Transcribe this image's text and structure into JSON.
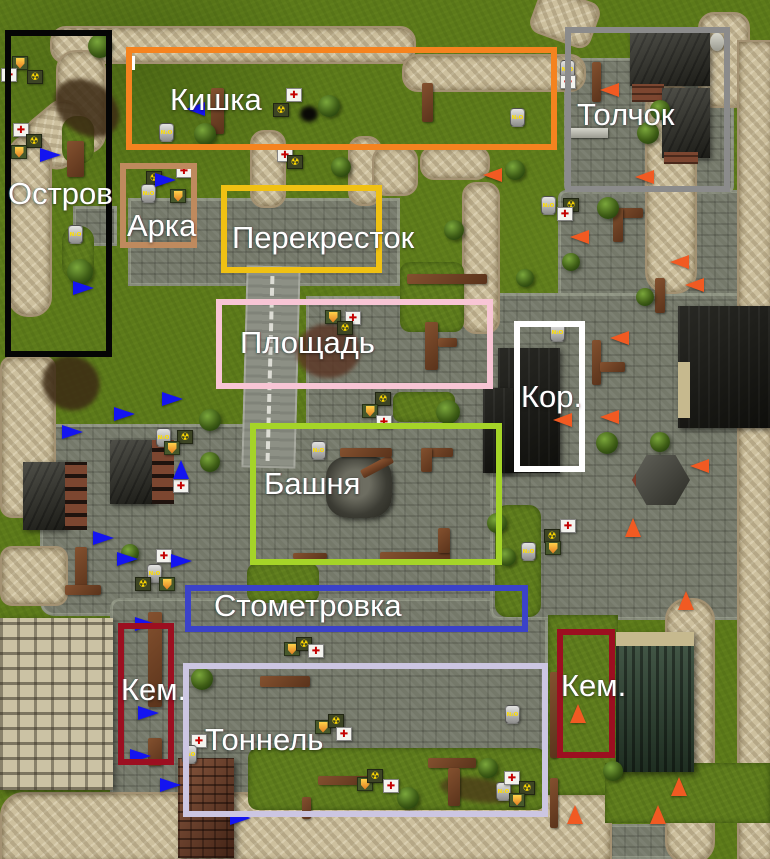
{
  "map_title": "Annotated game level map with callout zones and spawn markers",
  "regions": [
    {
      "name": "ostrov",
      "label": "Остров",
      "color": "#050505",
      "x": 5,
      "y": 30,
      "w": 107,
      "h": 327,
      "lx": 8,
      "ly": 178
    },
    {
      "name": "kishka",
      "label": "Кишка",
      "color": "#f5831f",
      "x": 126,
      "y": 47,
      "w": 431,
      "h": 103,
      "lx": 170,
      "ly": 84
    },
    {
      "name": "tolchok",
      "label": "Толчок",
      "color": "#8b8b8b",
      "x": 565,
      "y": 27,
      "w": 165,
      "h": 165,
      "lx": 577,
      "ly": 99
    },
    {
      "name": "arka",
      "label": "Арка",
      "color": "#bf8a5e",
      "x": 120,
      "y": 163,
      "w": 77,
      "h": 85,
      "lx": 127,
      "ly": 210
    },
    {
      "name": "perekrestok",
      "label": "Перекресток",
      "color": "#f0c113",
      "x": 221,
      "y": 185,
      "w": 161,
      "h": 88,
      "lx": 232,
      "ly": 222
    },
    {
      "name": "ploshchad",
      "label": "Площадь",
      "color": "#f8c5d5",
      "x": 216,
      "y": 299,
      "w": 277,
      "h": 90,
      "lx": 240,
      "ly": 327
    },
    {
      "name": "kor",
      "label": "Кор.",
      "color": "#ffffff",
      "x": 514,
      "y": 321,
      "w": 71,
      "h": 151,
      "lx": 521,
      "ly": 381
    },
    {
      "name": "bashnya",
      "label": "Башня",
      "color": "#a5d428",
      "x": 250,
      "y": 423,
      "w": 252,
      "h": 142,
      "lx": 264,
      "ly": 468
    },
    {
      "name": "stometrovka",
      "label": "Стометровка",
      "color": "#3b42c9",
      "x": 185,
      "y": 585,
      "w": 343,
      "h": 47,
      "lx": 214,
      "ly": 590
    },
    {
      "name": "kem-left",
      "label": "Кем.",
      "color": "#9c0f20",
      "x": 118,
      "y": 623,
      "w": 56,
      "h": 142,
      "lx": 121,
      "ly": 674
    },
    {
      "name": "kem-right",
      "label": "Кем.",
      "color": "#9c0f20",
      "x": 557,
      "y": 629,
      "w": 58,
      "h": 129,
      "lx": 561,
      "ly": 670
    },
    {
      "name": "tonnel",
      "label": "Тоннель",
      "color": "#ccc6e2",
      "x": 183,
      "y": 663,
      "w": 365,
      "h": 154,
      "lx": 205,
      "ly": 724
    }
  ],
  "markers": {
    "blue_color": "#1414f0",
    "orange_color": "#f15a22",
    "blue": [
      {
        "x": 50,
        "y": 155,
        "d": "right"
      },
      {
        "x": 83,
        "y": 288,
        "d": "right"
      },
      {
        "x": 165,
        "y": 180,
        "d": "right"
      },
      {
        "x": 196,
        "y": 109,
        "d": "left"
      },
      {
        "x": 172,
        "y": 399,
        "d": "right"
      },
      {
        "x": 124,
        "y": 414,
        "d": "right"
      },
      {
        "x": 72,
        "y": 432,
        "d": "right"
      },
      {
        "x": 183,
        "y": 470,
        "d": "up"
      },
      {
        "x": 103,
        "y": 538,
        "d": "right"
      },
      {
        "x": 127,
        "y": 559,
        "d": "right"
      },
      {
        "x": 181,
        "y": 561,
        "d": "right"
      },
      {
        "x": 145,
        "y": 624,
        "d": "right"
      },
      {
        "x": 148,
        "y": 713,
        "d": "right"
      },
      {
        "x": 140,
        "y": 756,
        "d": "right"
      },
      {
        "x": 170,
        "y": 785,
        "d": "right"
      },
      {
        "x": 240,
        "y": 818,
        "d": "right"
      }
    ],
    "orange": [
      {
        "x": 610,
        "y": 90,
        "d": "left"
      },
      {
        "x": 645,
        "y": 177,
        "d": "left"
      },
      {
        "x": 493,
        "y": 175,
        "d": "left"
      },
      {
        "x": 580,
        "y": 237,
        "d": "left"
      },
      {
        "x": 680,
        "y": 262,
        "d": "left"
      },
      {
        "x": 695,
        "y": 285,
        "d": "left"
      },
      {
        "x": 620,
        "y": 338,
        "d": "left"
      },
      {
        "x": 563,
        "y": 420,
        "d": "left"
      },
      {
        "x": 610,
        "y": 417,
        "d": "left"
      },
      {
        "x": 700,
        "y": 466,
        "d": "left"
      },
      {
        "x": 635,
        "y": 528,
        "d": "up"
      },
      {
        "x": 688,
        "y": 601,
        "d": "up"
      },
      {
        "x": 580,
        "y": 714,
        "d": "up"
      },
      {
        "x": 681,
        "y": 787,
        "d": "up"
      },
      {
        "x": 660,
        "y": 815,
        "d": "up"
      },
      {
        "x": 577,
        "y": 815,
        "d": "up"
      }
    ]
  },
  "item_glyphs": {
    "medkit": "✚",
    "radiation": "☢",
    "nitro": "N₂O",
    "shield": ""
  },
  "items": [
    {
      "t": "shield",
      "x": 20,
      "y": 64
    },
    {
      "t": "medkit",
      "x": 9,
      "y": 76
    },
    {
      "t": "radiation",
      "x": 35,
      "y": 78
    },
    {
      "t": "medkit",
      "x": 21,
      "y": 131
    },
    {
      "t": "radiation",
      "x": 34,
      "y": 142
    },
    {
      "t": "shield",
      "x": 19,
      "y": 153
    },
    {
      "t": "nitro",
      "x": 76,
      "y": 233
    },
    {
      "t": "medkit",
      "x": 184,
      "y": 172
    },
    {
      "t": "radiation",
      "x": 154,
      "y": 179
    },
    {
      "t": "nitro",
      "x": 149,
      "y": 192
    },
    {
      "t": "shield",
      "x": 178,
      "y": 197
    },
    {
      "t": "nitro",
      "x": 167,
      "y": 131
    },
    {
      "t": "medkit",
      "x": 294,
      "y": 96
    },
    {
      "t": "radiation",
      "x": 281,
      "y": 111
    },
    {
      "t": "medkit",
      "x": 285,
      "y": 156
    },
    {
      "t": "radiation",
      "x": 295,
      "y": 163
    },
    {
      "t": "nitro",
      "x": 518,
      "y": 116
    },
    {
      "t": "nitro",
      "x": 568,
      "y": 68
    },
    {
      "t": "medkit",
      "x": 568,
      "y": 83
    },
    {
      "t": "nitro",
      "x": 549,
      "y": 204
    },
    {
      "t": "radiation",
      "x": 571,
      "y": 206
    },
    {
      "t": "medkit",
      "x": 565,
      "y": 215
    },
    {
      "t": "shield",
      "x": 333,
      "y": 318
    },
    {
      "t": "medkit",
      "x": 353,
      "y": 319
    },
    {
      "t": "radiation",
      "x": 345,
      "y": 329
    },
    {
      "t": "radiation",
      "x": 383,
      "y": 400
    },
    {
      "t": "shield",
      "x": 370,
      "y": 412
    },
    {
      "t": "medkit",
      "x": 384,
      "y": 423
    },
    {
      "t": "nitro",
      "x": 319,
      "y": 449
    },
    {
      "t": "nitro",
      "x": 558,
      "y": 331
    },
    {
      "t": "medkit",
      "x": 568,
      "y": 527
    },
    {
      "t": "radiation",
      "x": 552,
      "y": 537
    },
    {
      "t": "shield",
      "x": 553,
      "y": 549
    },
    {
      "t": "nitro",
      "x": 529,
      "y": 550
    },
    {
      "t": "nitro",
      "x": 164,
      "y": 436
    },
    {
      "t": "radiation",
      "x": 185,
      "y": 438
    },
    {
      "t": "shield",
      "x": 172,
      "y": 449
    },
    {
      "t": "medkit",
      "x": 181,
      "y": 487
    },
    {
      "t": "medkit",
      "x": 164,
      "y": 557
    },
    {
      "t": "nitro",
      "x": 155,
      "y": 572
    },
    {
      "t": "radiation",
      "x": 143,
      "y": 585
    },
    {
      "t": "shield",
      "x": 167,
      "y": 585
    },
    {
      "t": "shield",
      "x": 292,
      "y": 650
    },
    {
      "t": "radiation",
      "x": 304,
      "y": 645
    },
    {
      "t": "medkit",
      "x": 316,
      "y": 652
    },
    {
      "t": "nitro",
      "x": 513,
      "y": 713
    },
    {
      "t": "medkit",
      "x": 199,
      "y": 742
    },
    {
      "t": "nitro",
      "x": 190,
      "y": 753
    },
    {
      "t": "shield",
      "x": 323,
      "y": 728
    },
    {
      "t": "radiation",
      "x": 336,
      "y": 722
    },
    {
      "t": "medkit",
      "x": 344,
      "y": 735
    },
    {
      "t": "shield",
      "x": 365,
      "y": 785
    },
    {
      "t": "radiation",
      "x": 375,
      "y": 777
    },
    {
      "t": "medkit",
      "x": 391,
      "y": 787
    },
    {
      "t": "nitro",
      "x": 504,
      "y": 790
    },
    {
      "t": "medkit",
      "x": 512,
      "y": 779
    },
    {
      "t": "radiation",
      "x": 527,
      "y": 789
    },
    {
      "t": "shield",
      "x": 517,
      "y": 801
    }
  ]
}
